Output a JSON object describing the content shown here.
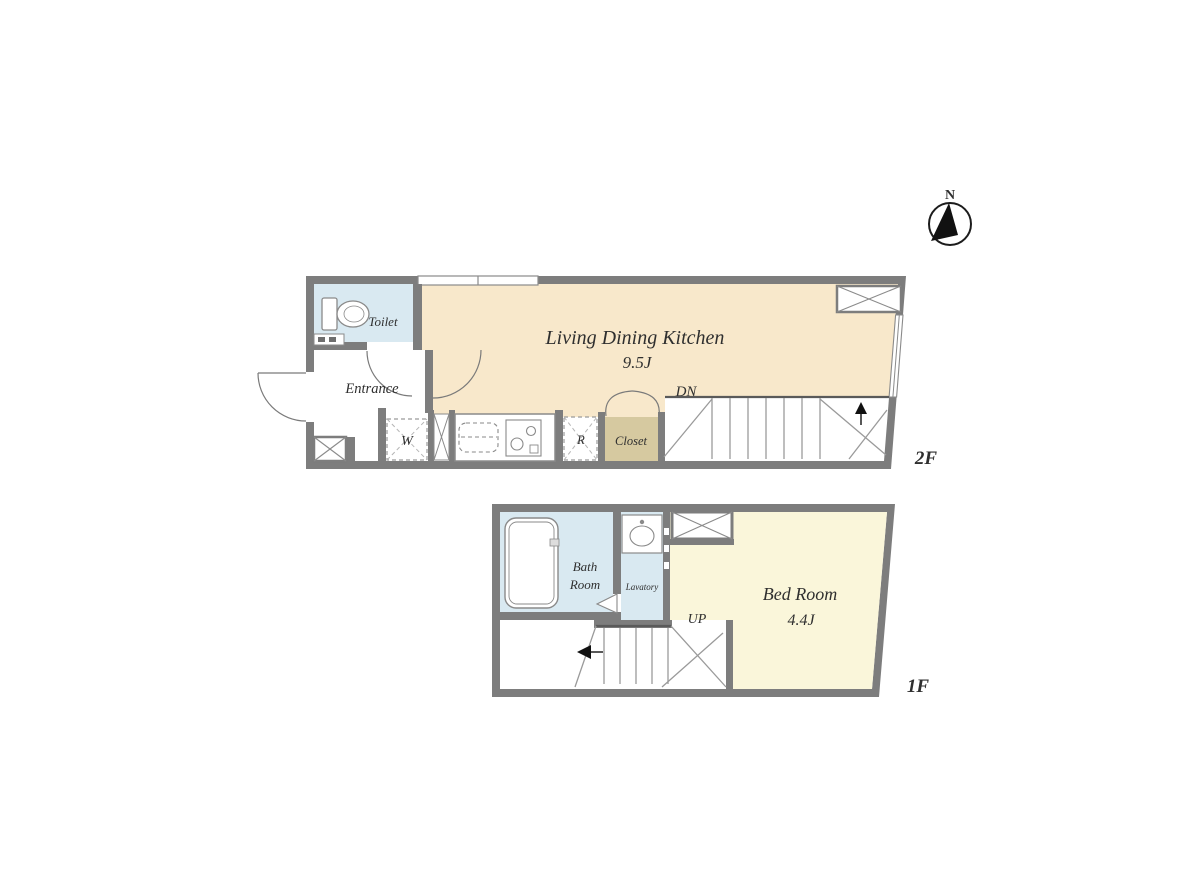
{
  "compass": {
    "north_label": "N"
  },
  "colors": {
    "wall": "#7d7d7d",
    "ldk_fill": "#f8e8cb",
    "bedroom_fill": "#faf6da",
    "wet_fill": "#d9e9f1",
    "closet_fill": "#d6c9a0",
    "fixture_line": "#8a8a8a",
    "text": "#2f2f2f"
  },
  "floor_2f": {
    "floor_label": "2F",
    "ldk": {
      "name": "Living Dining Kitchen",
      "size": "9.5J"
    },
    "toilet_label": "Toilet",
    "entrance_label": "Entrance",
    "washer_label": "W",
    "fridge_label": "R",
    "closet_label": "Closet",
    "stair_label": "DN"
  },
  "floor_1f": {
    "floor_label": "1F",
    "bath_label_line1": "Bath",
    "bath_label_line2": "Room",
    "lavatory_label": "Lavatory",
    "bedroom": {
      "name": "Bed Room",
      "size": "4.4J"
    },
    "stair_label": "UP"
  }
}
